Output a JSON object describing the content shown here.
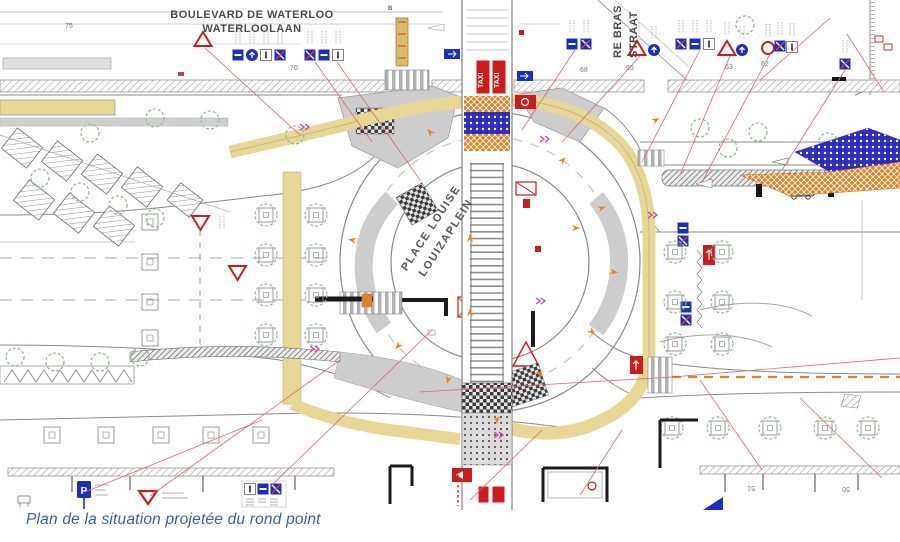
{
  "caption": "Plan de la situation projetée du rond point",
  "streets": {
    "boulevard_fr": "BOULEVARD DE WATERLOO",
    "boulevard_nl": "WATERLOOLAAN",
    "side_street_fr": "RE BRAS",
    "side_street_nl": "STRAAT",
    "place_fr": "PLACE LOUISE",
    "place_nl": "LOUIZAPLEIN"
  },
  "labels": {
    "taxi": "TAXI",
    "parking": "P",
    "stop_b": "B"
  },
  "street_numbers": {
    "n75": "75",
    "n70": "70",
    "n68": "68",
    "n65": "65",
    "n63": "63",
    "n62": "62",
    "n51": "51",
    "n50": "50"
  },
  "icons": {
    "warning-triangle-sign": "red outlined triangle",
    "yield-sign": "red inverted triangle",
    "blue-square-sign": "blue regulatory panel",
    "blue-circle-sign": "blue mandatory-direction disc",
    "no-entry-red-circle-sign": "red prohibition ring",
    "parking-sign": "blue P panel",
    "taxi-zone": "red kerb box TAXI",
    "tram-ladder": "tram track ladder marking",
    "zebra-crossing": "striped pedestrian crossing",
    "work-zone-orange": "orange crosshatched phase area",
    "work-zone-blue": "blue dotted phase area",
    "bike-lane": "ochre cycle band",
    "tree": "planted tree with crown"
  },
  "colors": {
    "bike_lane": "#e7d795",
    "work_orange": "#e8811c",
    "work_blue": "#2d2dc0",
    "sign_blue": "#1a2fbf",
    "alert_red": "#cc1c1c",
    "tree_green": "#8fbf8f",
    "paving_gray": "#cdcdcd",
    "line_gray": "#888888",
    "leader_red": "#e06868",
    "caption_blue": "#3a5fa8",
    "magenta_mark": "#d23ba0"
  }
}
